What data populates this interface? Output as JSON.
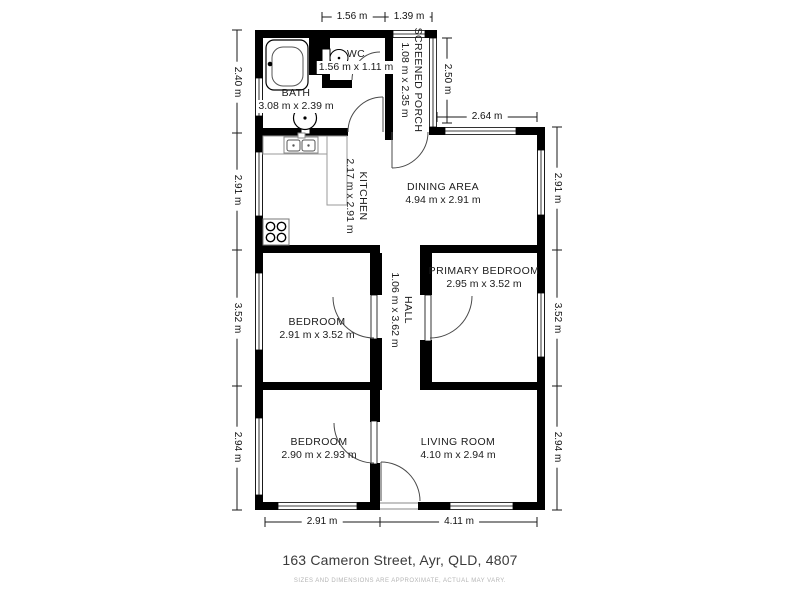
{
  "title": {
    "address": "163 Cameron Street, Ayr, QLD, 4807",
    "disclaimer": "SIZES AND DIMENSIONS ARE APPROXIMATE, ACTUAL MAY VARY."
  },
  "rooms": {
    "bath": {
      "name": "BATH",
      "dims": "3.08 m x 2.39 m"
    },
    "wc": {
      "name": "WC",
      "dims": "1.56 m x 1.11 m"
    },
    "screened_porch": {
      "name": "SCREENED PORCH",
      "dims": "1.08 m x 2.35 m"
    },
    "kitchen": {
      "name": "KITCHEN",
      "dims": "2.17 m x 2.91 m"
    },
    "dining": {
      "name": "DINING AREA",
      "dims": "4.94 m x 2.91 m"
    },
    "hall": {
      "name": "HALL",
      "dims": "1.06 m x 3.62 m"
    },
    "primary_bedroom": {
      "name": "PRIMARY BEDROOM",
      "dims": "2.95 m x 3.52 m"
    },
    "bedroom_mid": {
      "name": "BEDROOM",
      "dims": "2.91 m x 3.52 m"
    },
    "bedroom_bottom": {
      "name": "BEDROOM",
      "dims": "2.90 m x 2.93 m"
    },
    "living": {
      "name": "LIVING ROOM",
      "dims": "4.10 m x 2.94 m"
    }
  },
  "dimensions": {
    "top": [
      "1.56 m",
      "1.39 m"
    ],
    "left": [
      "2.40 m",
      "2.91 m",
      "3.52 m",
      "2.94 m"
    ],
    "right": [
      "2.91 m",
      "3.52 m",
      "2.94 m"
    ],
    "porch_height": "2.50 m",
    "top_right_width": "2.64 m",
    "bottom": [
      "2.91 m",
      "4.11 m"
    ]
  },
  "colors": {
    "wall": "#000000",
    "background": "#ffffff",
    "title_text": "#3a3a3a",
    "disclaimer_text": "#b5b5b5"
  }
}
